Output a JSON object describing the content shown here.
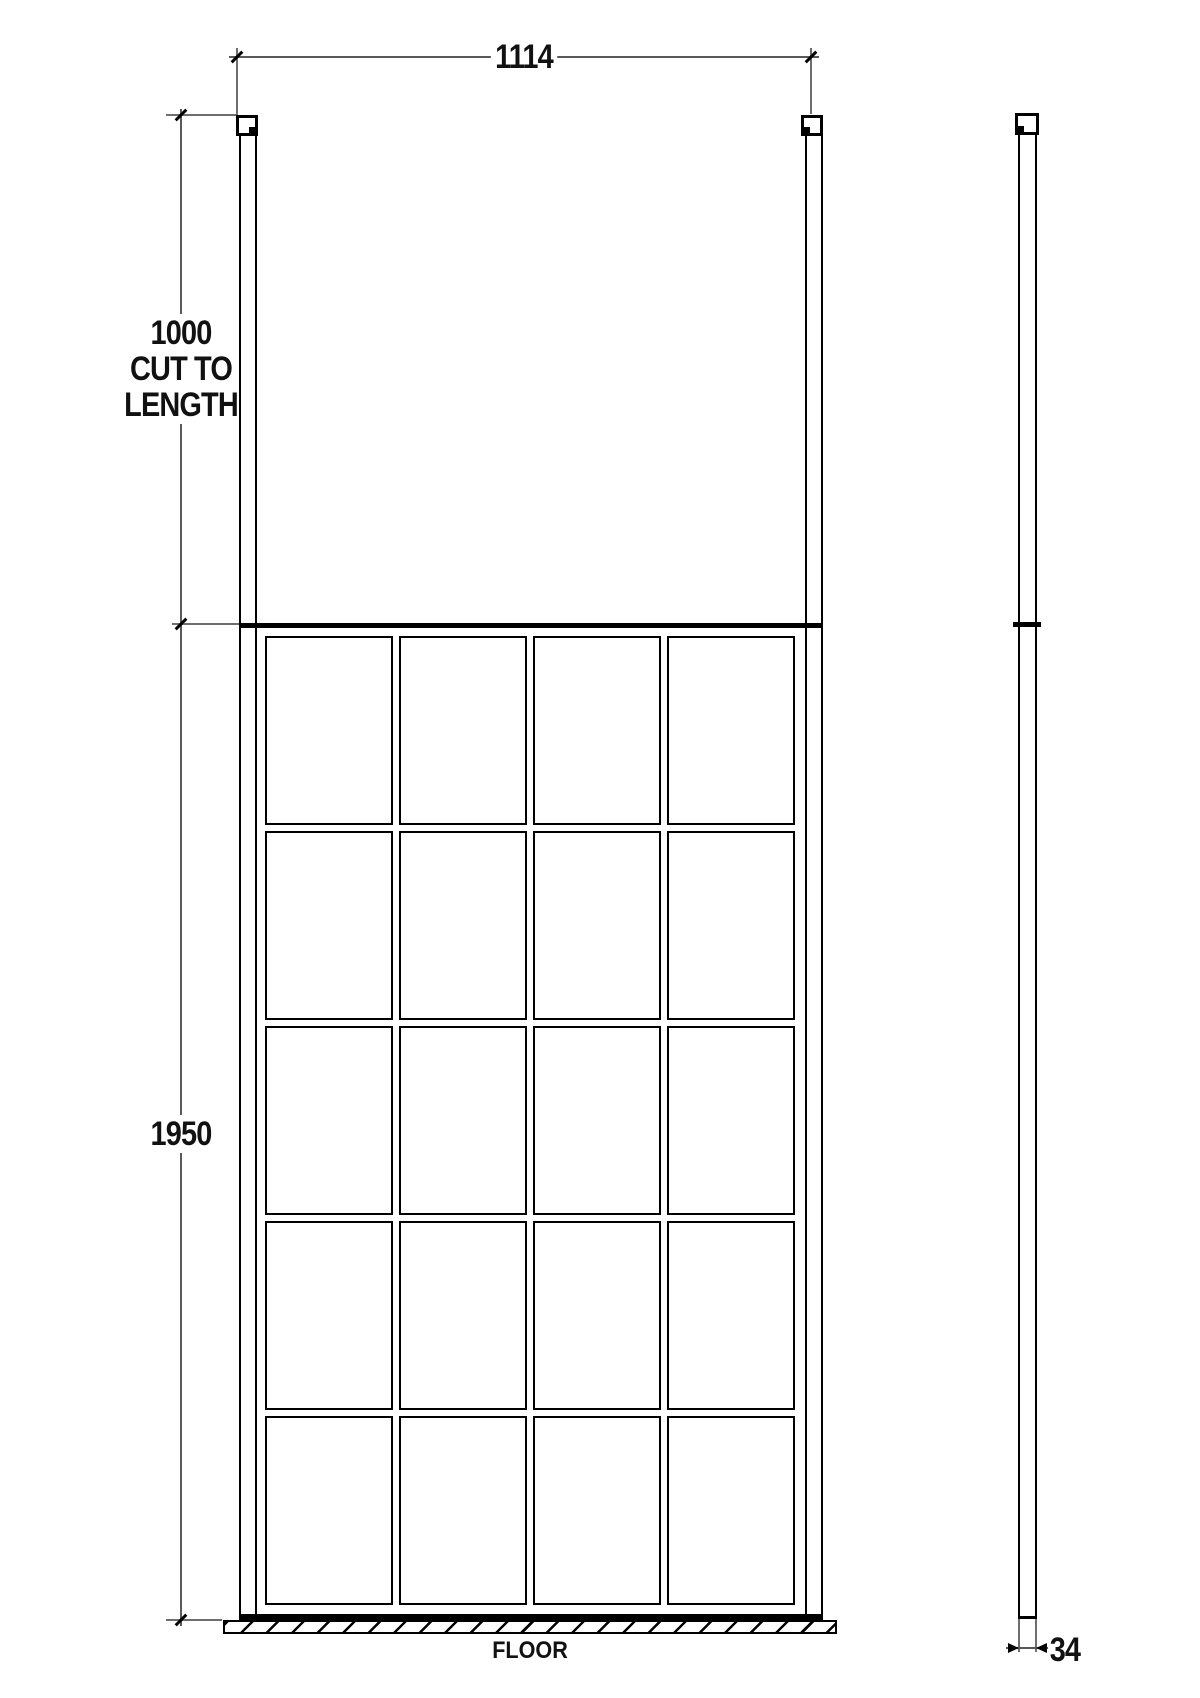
{
  "dims": {
    "width": "1114",
    "post_length": {
      "lines": [
        "1000",
        "CUT TO",
        "LENGTH"
      ]
    },
    "height": "1950",
    "thickness": "34"
  },
  "floor": {
    "label": "FLOOR"
  },
  "grid": {
    "cols": 4,
    "rows": 5
  },
  "colors": {
    "ink": "#000000",
    "dim_line": "#595959"
  }
}
